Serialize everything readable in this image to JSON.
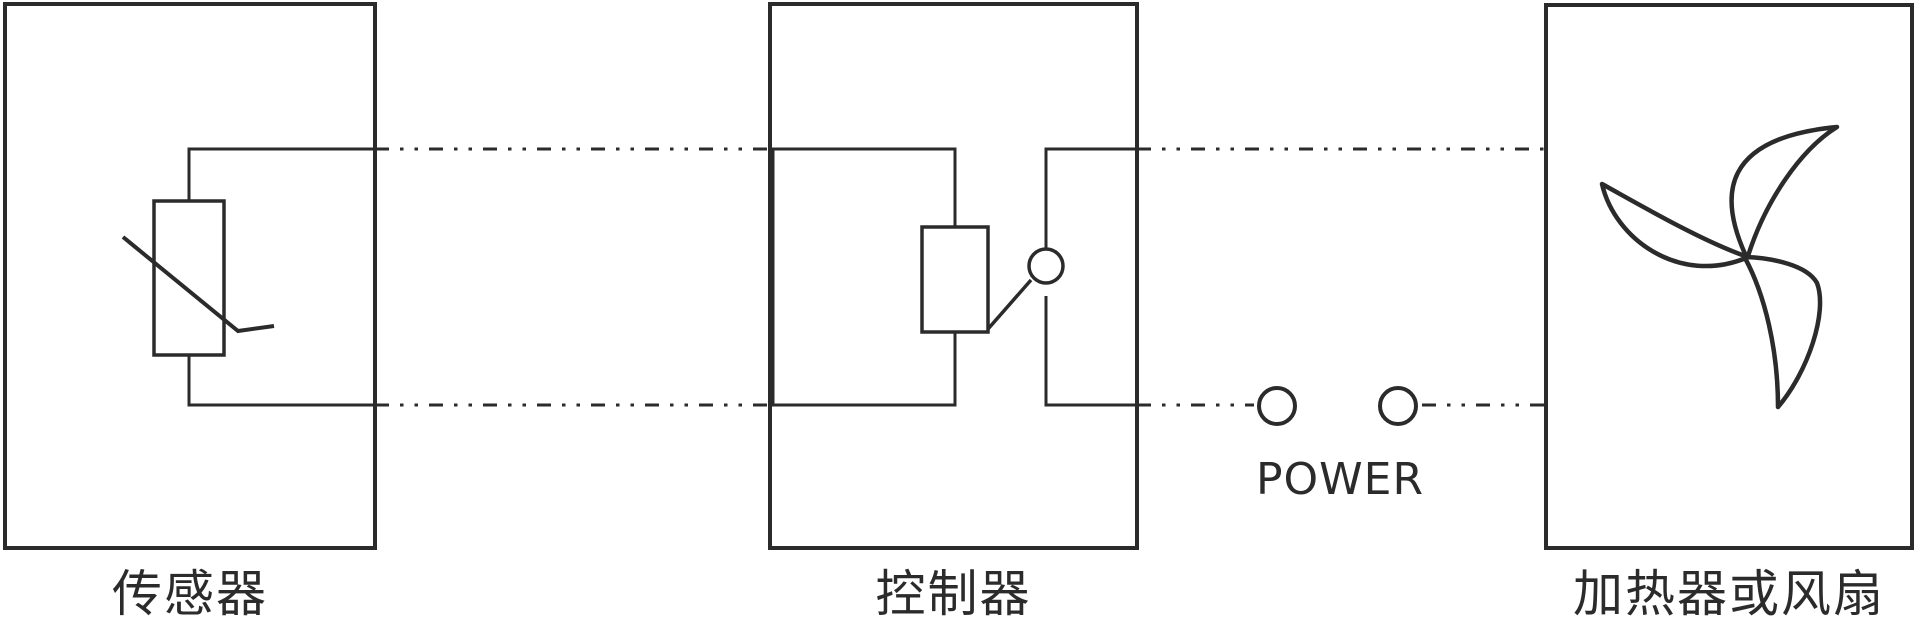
{
  "diagram": {
    "title": "temperature-control-wiring-diagram",
    "blocks": [
      {
        "id": "sensor",
        "label": "传感器",
        "symbol": "thermistor-icon"
      },
      {
        "id": "controller",
        "label": "控制器",
        "symbol": "relay-switch-icon"
      },
      {
        "id": "load",
        "label": "加热器或风扇",
        "symbol": "fan-icon"
      }
    ],
    "power": {
      "label": "POWER",
      "terminals": 2
    },
    "wires": {
      "style": "dash-dot-dot",
      "count": 4
    },
    "theme": {
      "ink": "#2b2b2b",
      "background": "#ffffff"
    }
  }
}
